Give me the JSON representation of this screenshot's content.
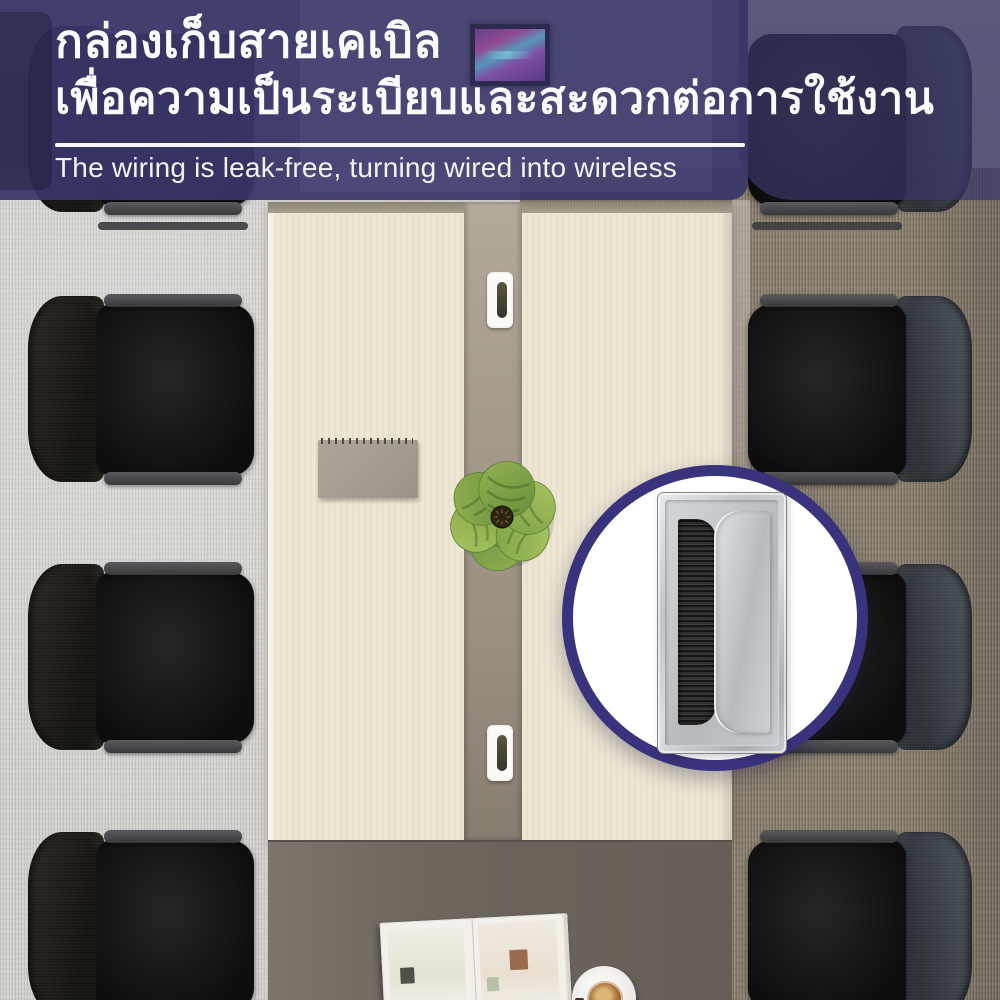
{
  "banner": {
    "headline_th_line1": "กล่องเก็บสายเคเบิล",
    "headline_th_line2": "เพื่อความเป็นระเบียบและสะดวกต่อการใช้งาน",
    "subheadline_en": "The wiring is leak-free, turning wired into wireless"
  },
  "colors": {
    "banner_navy": "#403f6c",
    "banner_overlay": "rgba(56,54,102,0.72)",
    "text_white": "#f5f5fa",
    "inset_ring_navy": "#39337d",
    "table_wood_cream": "#ece6d3",
    "table_channel_taupe": "#a39a8c",
    "table_end_dark": "#6c665d",
    "carpet_left_gray": "#d2d1ce",
    "carpet_right_taupe": "#8d8374",
    "chair_black": "#141414",
    "grommet_silver": "#c6c9cc",
    "grommet_brush_black": "#161616"
  }
}
